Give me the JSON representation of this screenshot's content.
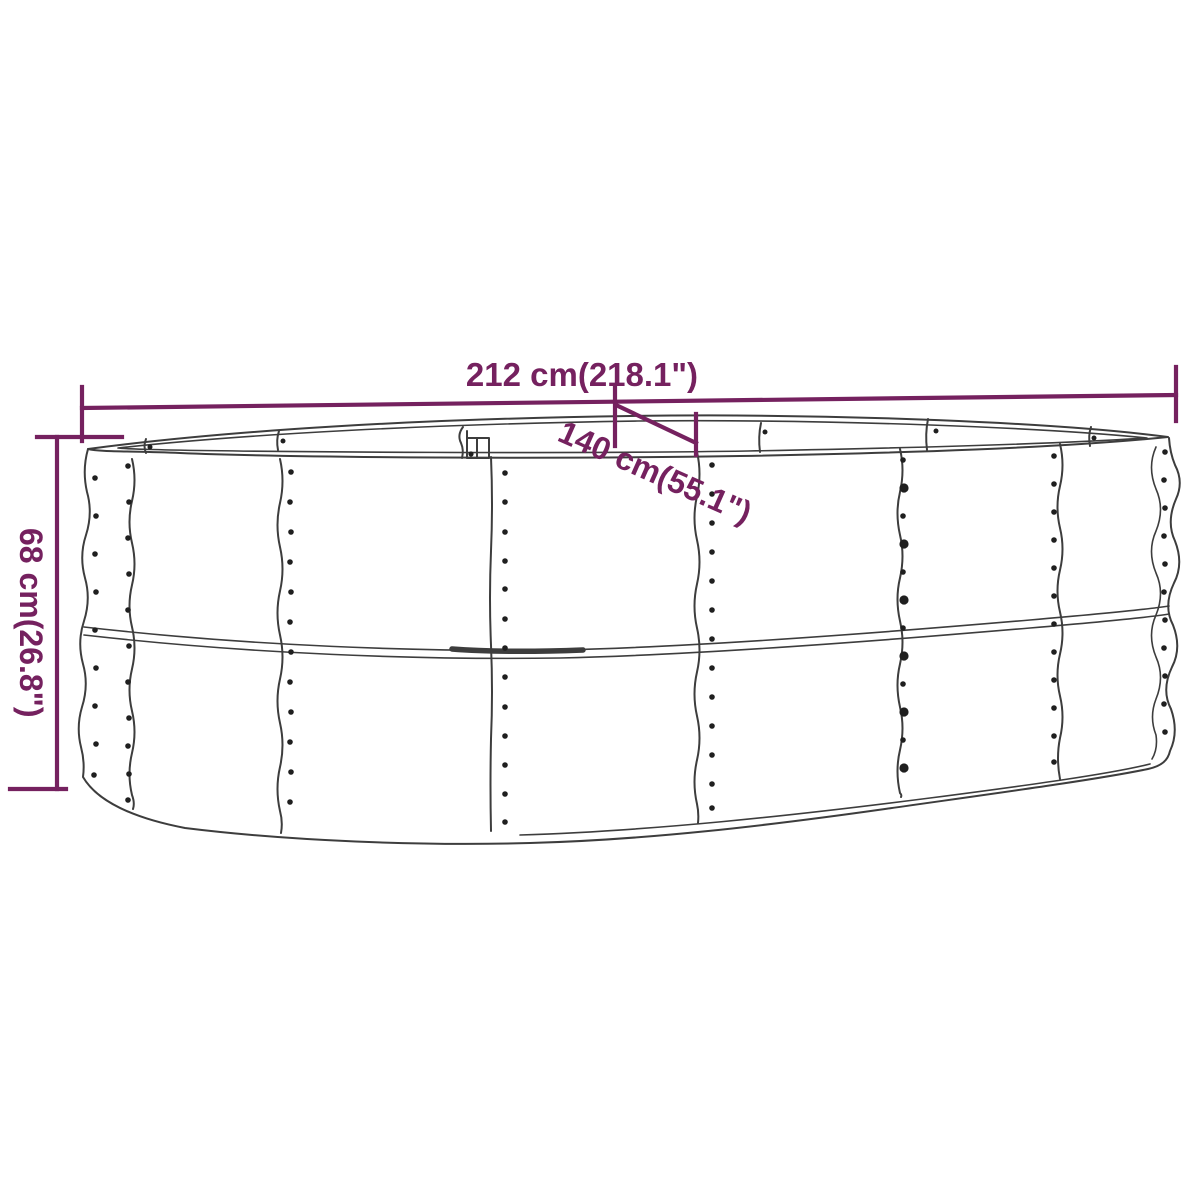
{
  "diagram": {
    "type": "product-dimension-drawing",
    "subject": "oval raised garden bed / planter, corrugated steel, 3/4 perspective line drawing",
    "dimensions": {
      "width_label": "212 cm(218.1\")",
      "depth_label": "140 cm(55.1\")",
      "height_label": "68 cm(26.8\")"
    },
    "colors": {
      "dimension": "#75215f",
      "line": "#3d3d3d",
      "rivet": "#1f1f1f",
      "background": "#ffffff"
    }
  }
}
